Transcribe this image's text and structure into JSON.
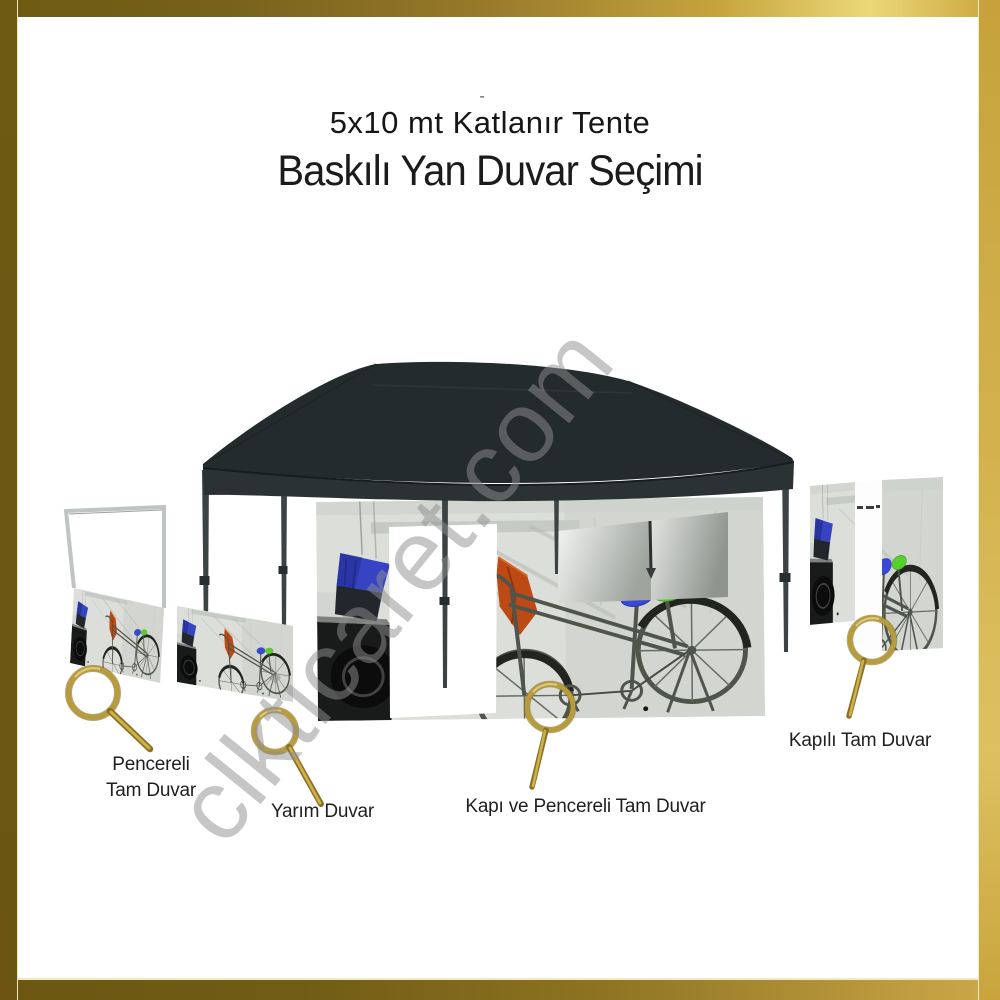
{
  "header": {
    "tick": "-",
    "title_line1": "5x10 mt Katlanır Tente",
    "title_line2": "Baskılı Yan Duvar Seçimi"
  },
  "watermark": {
    "text": "clkticaret.com",
    "color": "#8f8f8f"
  },
  "tent": {
    "canopy_color": "#242b2c",
    "leg_color": "#3c4344"
  },
  "options": [
    {
      "id": "pencereli-tam-duvar",
      "label": "Pencereli\nTam Duvar",
      "icon": "magnifier-icon"
    },
    {
      "id": "yarim-duvar",
      "label": "Yarım Duvar",
      "icon": "magnifier-icon"
    },
    {
      "id": "kapi-ve-pencereli-tam-duvar",
      "label": "Kapı ve Pencereli Tam Duvar",
      "icon": "magnifier-icon"
    },
    {
      "id": "kapili-tam-duvar",
      "label": "Kapılı Tam Duvar",
      "icon": "magnifier-icon"
    }
  ],
  "colors": {
    "frame_gold_dark": "#6e5a12",
    "frame_gold_light": "#ecd877",
    "magnifier_gold": "#b19134",
    "print_accent_blue": "#3a49d2",
    "print_accent_green": "#57cf2c",
    "print_accent_orange": "#bd4a15",
    "window_pane_gray": "#9fa49f"
  }
}
